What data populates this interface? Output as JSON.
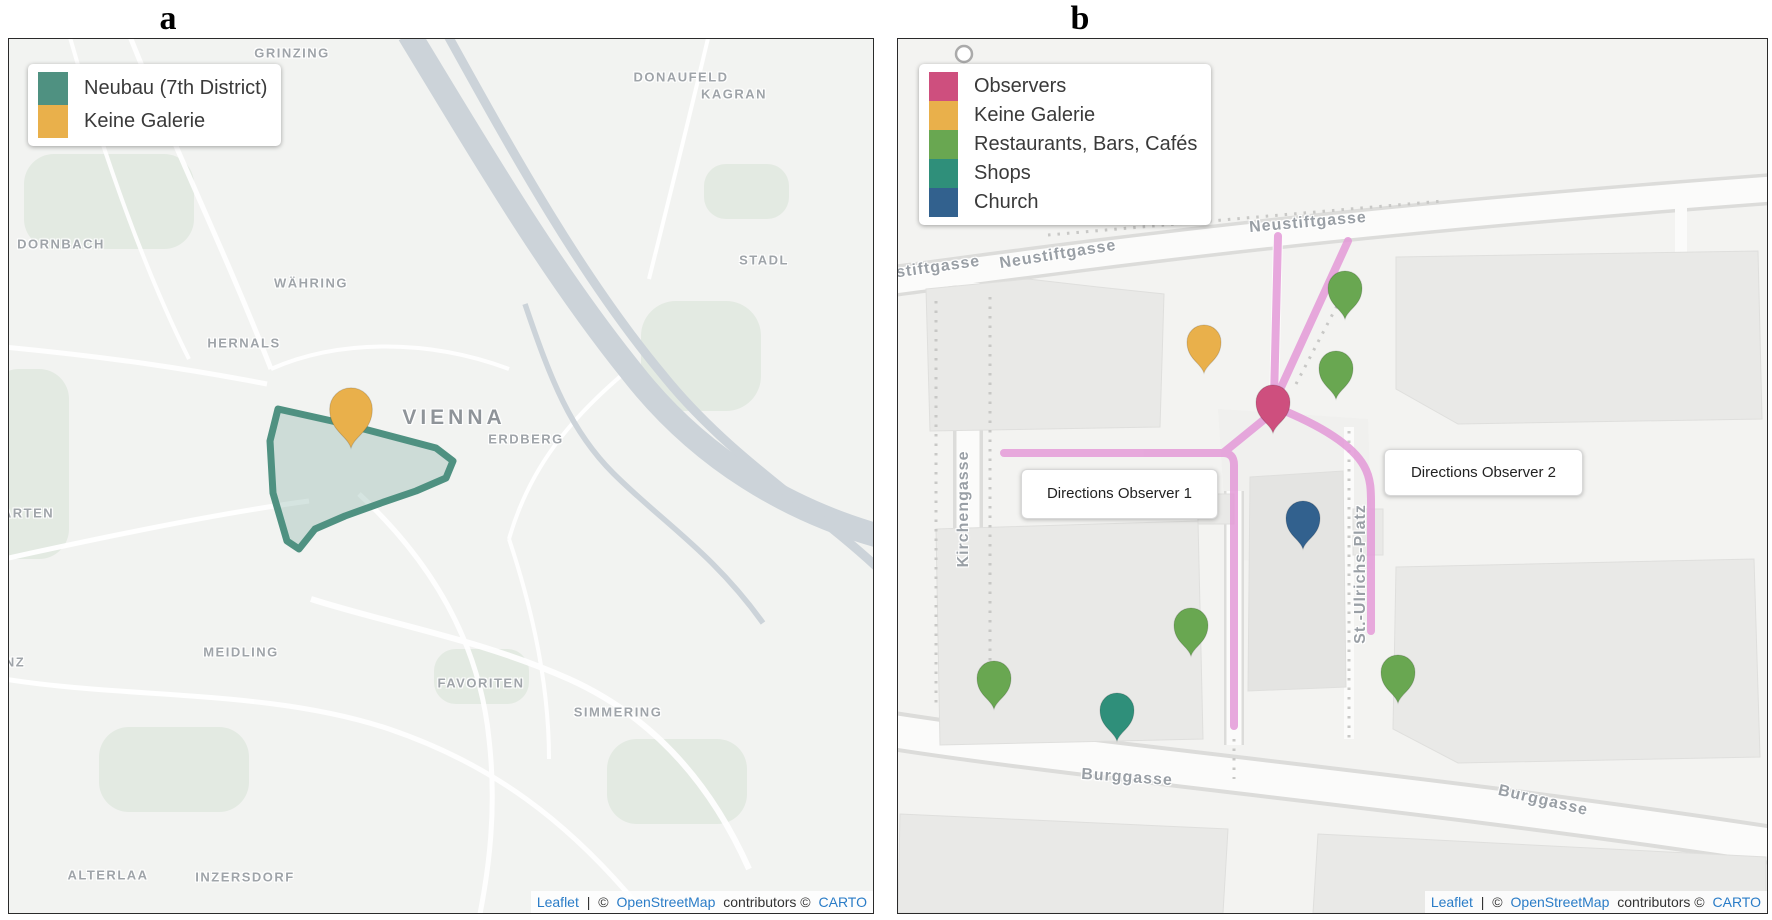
{
  "figure": {
    "panel_a_letter": "a",
    "panel_b_letter": "b"
  },
  "colors": {
    "polygon_teal": "#4f9181",
    "polygon_fill": "rgba(120,170,155,0.30)",
    "orange": "#e9b04b",
    "observer_pink": "#ce4f7e",
    "green": "#69a751",
    "teal": "#2f8f7a",
    "blue": "#32618e",
    "route_pink": "#e49ad8",
    "river_gray": "#ccd3d9",
    "label_gray": "#9fa4a9",
    "link_blue": "#2a7cc7"
  },
  "panel_a": {
    "legend_items": [
      {
        "label": "Neubau (7th District)"
      },
      {
        "label": "Keine Galerie"
      }
    ],
    "city": "VIENNA",
    "districts": [
      "GRINZING",
      "DONAUFELD",
      "KAGRAN",
      "DORNBACH",
      "WÄHRING",
      "STADL",
      "HERNALS",
      "ERDBERG",
      "ARTEN",
      "MEIDLING",
      "NZ",
      "FAVORITEN",
      "SIMMERING",
      "ALTERLAA",
      "INZERSDORF"
    ]
  },
  "panel_b": {
    "legend_items": [
      {
        "label": "Observers"
      },
      {
        "label": "Keine Galerie"
      },
      {
        "label": "Restaurants, Bars, Cafés"
      },
      {
        "label": "Shops"
      },
      {
        "label": "Church"
      }
    ],
    "streets": [
      "eustiftgasse",
      "Neustiftgasse",
      "Neustiftgasse",
      "Kirchengasse",
      "St.-Ulrichs-Platz",
      "Burggasse",
      "Burggasse"
    ],
    "tooltips": [
      "Directions Observer 1",
      "Directions Observer 2"
    ]
  },
  "attribution": {
    "leaflet": "Leaflet",
    "pipe": "|",
    "copy1": "©",
    "osm": "OpenStreetMap",
    "contributors": "contributors ©",
    "carto": "CARTO"
  }
}
